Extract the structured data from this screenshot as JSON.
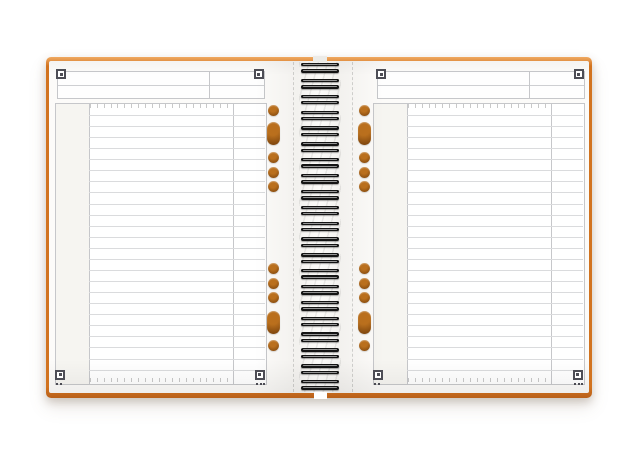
{
  "scene": {
    "type": "product-photo",
    "description": "Open spiral-bound notebook with an orange cover and lined white pages, photographed on a plain white background",
    "background_color": "#ffffff"
  },
  "notebook": {
    "cover": {
      "color_top": "#efa961",
      "color_main": "#d2731f",
      "color_dark": "#b8601a"
    },
    "paper": {
      "page_color": "#fcfbf9",
      "margin_column_color": "#f6f5f1",
      "frame_color": "#c6c7ca",
      "rule_color": "#dadbdd",
      "perforation_color": "#cfcfcd"
    },
    "rules": {
      "line_count": 24,
      "tick_count": 21
    },
    "spiral": {
      "coil_count": 21,
      "color": "#141414"
    },
    "holes": {
      "color_inner": "#bc701c",
      "color_outer": "#7a420b",
      "pattern_top": [
        "circle",
        "pill",
        "circle",
        "circle",
        "circle"
      ],
      "pattern_bottom": [
        "circle",
        "circle",
        "circle",
        "pill",
        "circle"
      ]
    },
    "corner_markers": {
      "color": "#4d4d55",
      "per_page": 4,
      "dots_bottom_left": 2,
      "dots_bottom_right": 3
    },
    "pages": [
      {
        "side": "left"
      },
      {
        "side": "right"
      }
    ]
  }
}
